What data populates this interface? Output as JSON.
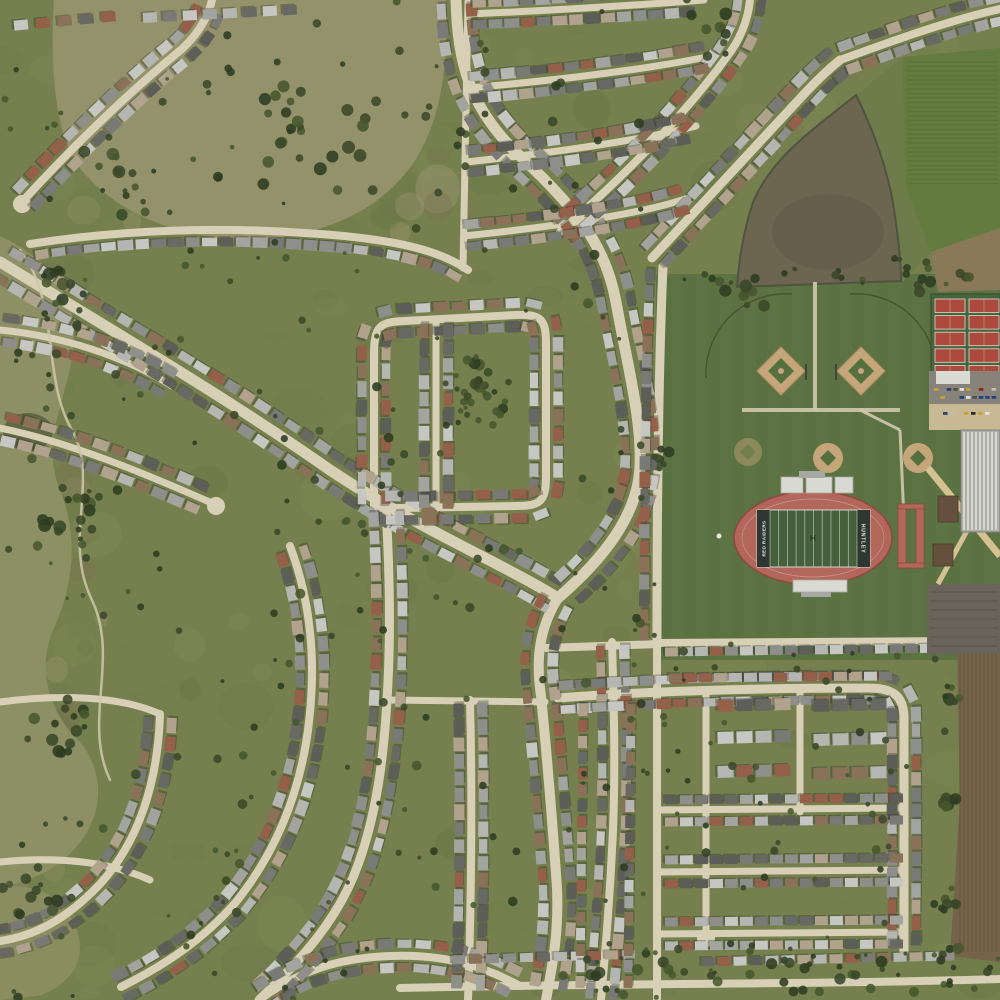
{
  "meta": {
    "description": "Aerial satellite view of a suburban subdivision with curving streets, a pond, farmland, and a high-school sports complex",
    "stadium_home_text": "RED RAIDERS",
    "stadium_away_text": "HUNTLEY",
    "midfield_mark": "H"
  },
  "palette": {
    "base": "#75804e",
    "road": "#d7d0b6",
    "trail": "#cfc9ac",
    "dirtRoad": "#cfc6a5",
    "shadow": "#23281b",
    "houses": [
      "#b5b5b1",
      "#a3a39f",
      "#8e8e8a",
      "#797975",
      "#696964",
      "#b0a28c",
      "#8a7258",
      "#95604a",
      "#c6c6c2",
      "#5e5e59"
    ],
    "trees": [
      "#3a4829",
      "#2e3c21",
      "#47562e"
    ],
    "scrub": "#93926a",
    "corridor": "#8d9064",
    "scrubB": "#8a8d60",
    "pond": "#6c6550",
    "pondDeep": "#615a46",
    "pondEdge": "#4e5440",
    "wetland": "#59603f",
    "farmGreen": "#647b3f",
    "farmStripe": "#597036",
    "grassStrip": "#6e7b4a",
    "farmBrownNE": "#8a7957",
    "farmBrownE": "#75644a",
    "farmStriate": "#5c4e38",
    "sports": "#5e7343",
    "sportsStripe": "#53673a",
    "track": "#b3675b",
    "trackEdge": "#8c4a40",
    "field": "#45603a",
    "endzone": "#2f3733",
    "lineWhite": "#dfe3da",
    "bleacher": "#d9d9d3",
    "bleacherDark": "#a8a8a2",
    "infield": "#c5a67b",
    "infieldEdge": "#ac8f63",
    "infieldGreen": "#55703e",
    "fenceDark": "#3f4c2c",
    "tennisRed": "#ac4a3e",
    "tennisGreen": "#47663f",
    "courtLine": "#ddd8cd",
    "lot": "#87837a",
    "lotDark": "#69655b",
    "lotLine": "#59554b",
    "canopy": "#dbdbd6",
    "drive": "#c8b995",
    "plaza": "#d4c191",
    "school": "#aeaea9",
    "schoolStripe": "#d7d7d2",
    "brown": "#65503e",
    "cars": [
      "#e0e0db",
      "#2b2b2b",
      "#93241e",
      "#24407e",
      "#bdbdb8",
      "#50504b",
      "#c7a23a"
    ],
    "mottle": [
      "#6d7a4a",
      "#83905a",
      "#5f6c40"
    ],
    "scrubMottle": [
      "#7b7052",
      "#9a9570",
      "#6e7a4e"
    ]
  },
  "scene": {
    "seed": 42,
    "mottle": [
      {
        "x": 0,
        "y": 0,
        "w": 1000,
        "h": 1000,
        "n": 160,
        "colors": "mottle",
        "rMin": 8,
        "rMax": 30,
        "opMin": 0.1,
        "opMax": 0.25
      },
      {
        "x": 60,
        "y": 0,
        "w": 380,
        "h": 235,
        "n": 50,
        "colors": "scrubMottle",
        "rMin": 6,
        "rMax": 26,
        "opMin": 0.25,
        "opMax": 0.5
      },
      {
        "x": 0,
        "y": 240,
        "w": 105,
        "h": 650,
        "n": 40,
        "colors": "scrubMottle",
        "rMin": 5,
        "rMax": 20,
        "opMin": 0.2,
        "opMax": 0.45
      }
    ],
    "regionsA": [
      {
        "type": "path",
        "name": "scrub-meadow-northwest",
        "d": "M54,0 L446,0 C448,62 442,112 420,152 C390,206 328,236 258,239 C178,242 108,210 74,160 C54,122 50,62 54,0 Z",
        "fill": "scrub"
      },
      {
        "type": "path",
        "name": "open-land-west-corridor",
        "d": "M0,236 C52,260 80,300 73,352 C66,402 40,440 60,490 C80,540 72,590 53,630 C37,668 48,710 78,740 C100,764 105,800 88,830 C70,862 40,880 0,887 Z",
        "fill": "corridor"
      },
      {
        "type": "path",
        "name": "scrub-southwest",
        "d": "M0,887 C40,881 72,902 79,938 C84,963 69,986 38,996 L0,1000 Z",
        "fill": "scrubB"
      },
      {
        "type": "rect",
        "name": "sports-complex-grounds",
        "x": 656,
        "y": 274,
        "w": 344,
        "h": 386,
        "fill": "sports"
      },
      {
        "type": "path",
        "name": "farm-field-northeast",
        "d": "M903,57 L1000,48 L1000,228 L931,252 L905,186 Z",
        "fill": "farmGreen"
      }
    ],
    "stripes1": [
      {
        "axis": "h",
        "x1": 907,
        "x2": 998,
        "y1": 62,
        "y2": 184,
        "step": 4.5,
        "stroke": "farmStripe",
        "w": 1.6,
        "op": 0.7
      },
      {
        "axis": "v",
        "x1": 666,
        "x2": 996,
        "y1": 276,
        "y2": 658,
        "step": 24,
        "stroke": "sportsStripe",
        "w": 11,
        "op": 0.16
      }
    ],
    "regionsB": [
      {
        "type": "path",
        "name": "grass-strip-pond-east",
        "d": "M856,95 L903,57 L905,186 L931,252 L903,282 Z",
        "fill": "grassStrip"
      },
      {
        "type": "path",
        "name": "farm-brown-northeast",
        "d": "M931,252 L1000,228 L1000,290 L938,292 Z",
        "fill": "farmBrownNE"
      },
      {
        "type": "path",
        "name": "plowed-field-east",
        "d": "M957,640 L1000,640 L1000,962 L950,956 L960,800 Z",
        "fill": "farmBrownE"
      },
      {
        "type": "path",
        "name": "retention-pond",
        "d": "M856,95 C867,117 885,158 893,203 C898,235 901,261 901,281 L737,287 C739,257 744,231 752,205 C770,158 814,129 856,95 Z",
        "fill": "pond",
        "stroke": "pondEdge",
        "sw": 2
      },
      {
        "type": "ellipse",
        "name": "pond-deep-water",
        "cx": 828,
        "cy": 232,
        "rx": 56,
        "ry": 38,
        "fill": "pondDeep",
        "op": 0.55
      },
      {
        "type": "ellipse",
        "name": "wetland-patch",
        "cx": 28,
        "cy": 432,
        "rx": 25,
        "ry": 19,
        "fill": "wetland",
        "op": 0.85
      }
    ],
    "stripes2": [
      {
        "axis": "v",
        "x1": 960,
        "x2": 998,
        "y1": 652,
        "y2": 952,
        "step": 4,
        "stroke": "farmStriate",
        "w": 1.4,
        "op": 0.45
      }
    ],
    "roads": [
      {
        "d": "M0,262 C120,335 230,400 330,470 C420,530 500,562 558,598",
        "w": 11,
        "hs": 18,
        "off": 15,
        "sides": [
          1,
          -1
        ]
      },
      {
        "d": "M456,0 C458,62 468,108 522,158 C576,208 606,246 616,302 C628,368 642,420 640,466 C638,516 602,560 558,598",
        "w": 11,
        "hs": 18,
        "off": 15,
        "sides": [
          1,
          -1
        ]
      },
      {
        "d": "M558,598 C538,630 536,662 541,696 C548,766 553,830 557,888 C559,936 552,966 546,1000",
        "w": 10,
        "hs": 18,
        "off": 14,
        "sides": [
          1,
          -1
        ]
      },
      {
        "d": "M663,266 C659,360 657,470 657,642",
        "w": 9,
        "hs": 17,
        "off": 13,
        "sides": [
          1
        ]
      },
      {
        "d": "M652,258 C700,206 756,146 806,92 C820,77 830,68 840,60",
        "w": 9,
        "hs": 17,
        "off": 13,
        "sides": [
          1,
          -1
        ]
      },
      {
        "d": "M840,60 C895,40 950,20 1000,9",
        "w": 8,
        "hs": 17,
        "off": 12,
        "sides": [
          1,
          -1
        ]
      },
      {
        "d": "M560,232 C622,178 682,118 726,58 C740,40 748,20 750,0",
        "w": 8,
        "hs": 17,
        "off": 12,
        "sides": [
          1,
          -1
        ]
      },
      {
        "d": "M22,202 C62,158 122,98 176,54 C196,38 208,18 212,0",
        "w": 8,
        "hs": 18,
        "off": 12,
        "sides": [
          1,
          -1
        ],
        "bulb": [
          [
            22,
            204
          ]
        ]
      },
      {
        "d": "M30,244 C120,230 220,226 320,234 C402,240 442,252 468,270",
        "w": 8,
        "hs": 17,
        "off": 12,
        "sides": [
          1
        ]
      },
      {
        "d": "M374,508 L374,354 C374,326 380,322 404,321 L516,315 C542,314 546,320 546,344 L546,476 C546,502 540,506 516,506 L404,508 Z",
        "w": 8,
        "hs": 18,
        "off": 12,
        "sides": [
          1,
          -1
        ]
      },
      {
        "d": "M436,321 L436,507",
        "w": 7,
        "hs": 17,
        "off": 12,
        "sides": [
          1,
          -1
        ]
      },
      {
        "d": "M470,14 C560,10 640,5 704,0",
        "w": 7,
        "hs": 16,
        "off": 11,
        "sides": [
          1,
          -1
        ]
      },
      {
        "d": "M468,88 C560,80 640,70 702,58",
        "w": 7,
        "hs": 16,
        "off": 11,
        "sides": [
          1,
          -1
        ]
      },
      {
        "d": "M466,162 C560,152 642,140 696,126",
        "w": 7,
        "hs": 16,
        "off": 11,
        "sides": [
          1,
          -1
        ]
      },
      {
        "d": "M464,236 C560,226 642,214 688,198",
        "w": 7,
        "hs": 16,
        "off": 11,
        "sides": [
          1,
          -1
        ]
      },
      {
        "d": "M468,2 L463,268",
        "w": 7
      },
      {
        "d": "M0,330 C62,336 124,356 172,386",
        "w": 7,
        "hs": 18,
        "off": 12,
        "sides": [
          1,
          -1
        ]
      },
      {
        "d": "M0,428 C70,442 146,474 214,504",
        "w": 7,
        "hs": 18,
        "off": 12,
        "sides": [
          1,
          -1
        ],
        "bulb": [
          [
            216,
            506
          ]
        ]
      },
      {
        "d": "M386,508 C389,560 391,620 388,682 C385,744 379,806 359,862 C339,920 299,962 259,1000",
        "w": 9,
        "hs": 18,
        "off": 13,
        "sides": [
          1,
          -1
        ]
      },
      {
        "d": "M290,546 C311,602 316,662 309,722 C301,792 276,852 236,902 C201,942 161,967 121,987",
        "w": 8,
        "hs": 18,
        "off": 12,
        "sides": [
          1,
          -1
        ]
      },
      {
        "d": "M160,714 C158,780 140,840 100,884 C66,920 34,936 0,941",
        "w": 8,
        "hs": 18,
        "off": 12,
        "sides": [
          1,
          -1
        ]
      },
      {
        "d": "M0,702 C60,694 120,696 160,714",
        "w": 7
      },
      {
        "d": "M0,862 C60,856 110,862 150,880",
        "w": 7
      },
      {
        "d": "M259,1000 C300,970 340,958 390,956 C440,954 480,964 520,986",
        "w": 8,
        "hs": 18,
        "off": 12,
        "sides": [
          1,
          -1
        ]
      },
      {
        "d": "M470,700 C472,780 472,880 468,1000",
        "w": 8,
        "hs": 17,
        "off": 12,
        "sides": [
          1,
          -1
        ]
      },
      {
        "d": "M388,700 L545,702",
        "w": 7
      },
      {
        "d": "M612,642 C614,710 616,780 612,850 C609,910 605,955 601,1000",
        "w": 8,
        "hs": 17,
        "off": 12,
        "sides": [
          1,
          -1
        ]
      },
      {
        "d": "M546,648 L658,644",
        "w": 8
      },
      {
        "d": "M558,698 C650,691 760,688 868,688 C896,688 903,698 904,716 L904,952",
        "w": 9,
        "hs": 16,
        "off": 12,
        "sides": [
          1,
          -1
        ]
      },
      {
        "d": "M657,643 L957,641",
        "w": 8
      },
      {
        "d": "M657,645 L657,1000",
        "w": 8
      },
      {
        "d": "M706,690 L706,936",
        "w": 7,
        "bulb": [
          [
            706,
            938
          ]
        ]
      },
      {
        "d": "M800,690 L800,812",
        "w": 7
      },
      {
        "d": "M658,810 L902,808",
        "w": 7
      },
      {
        "d": "M658,872 L902,870",
        "w": 7
      },
      {
        "d": "M658,934 L902,932",
        "w": 7
      },
      {
        "d": "M400,988 C600,983 800,985 1000,979",
        "w": 8
      }
    ],
    "trails": [
      {
        "d": "M20,250 C60,300 42,380 72,430 C100,480 62,540 92,600 C120,660 82,720 110,780",
        "w": 2.5,
        "stroke": "trail"
      }
    ],
    "houseRows": [
      [
        10,
        26,
        118,
        16,
        22,
        14,
        10
      ],
      [
        140,
        18,
        308,
        9,
        20,
        14,
        10
      ],
      [
        664,
        652,
        952,
        648,
        15,
        13,
        9
      ],
      [
        668,
        678,
        894,
        676,
        15,
        13,
        9
      ],
      [
        716,
        706,
        792,
        704,
        19,
        16,
        12
      ],
      [
        716,
        738,
        792,
        736,
        19,
        16,
        12
      ],
      [
        716,
        772,
        792,
        770,
        19,
        16,
        12
      ],
      [
        812,
        706,
        892,
        704,
        19,
        16,
        12
      ],
      [
        812,
        740,
        892,
        738,
        19,
        16,
        12
      ],
      [
        812,
        774,
        892,
        772,
        19,
        16,
        12
      ],
      [
        664,
        800,
        898,
        798,
        15,
        13,
        9
      ],
      [
        664,
        822,
        898,
        820,
        15,
        13,
        9
      ],
      [
        664,
        860,
        898,
        858,
        15,
        13,
        9
      ],
      [
        664,
        884,
        898,
        882,
        15,
        13,
        9
      ],
      [
        664,
        922,
        898,
        920,
        15,
        13,
        9
      ],
      [
        664,
        946,
        898,
        944,
        15,
        13,
        9
      ],
      [
        450,
        960,
        640,
        954,
        17,
        13,
        9
      ],
      [
        700,
        962,
        950,
        956,
        16,
        13,
        9
      ],
      [
        583,
        702,
        580,
        986,
        16,
        12,
        9
      ],
      [
        631,
        702,
        628,
        986,
        16,
        12,
        9
      ]
    ],
    "treeClusters": [
      {
        "x": 480,
        "y": 398,
        "r": 42,
        "n": 30
      },
      {
        "x": 300,
        "y": 120,
        "r": 80,
        "n": 26
      },
      {
        "x": 120,
        "y": 180,
        "r": 50,
        "n": 14
      },
      {
        "x": 55,
        "y": 300,
        "r": 40,
        "n": 16
      },
      {
        "x": 60,
        "y": 520,
        "r": 45,
        "n": 16
      },
      {
        "x": 70,
        "y": 720,
        "r": 45,
        "n": 16
      },
      {
        "x": 40,
        "y": 900,
        "r": 45,
        "n": 14
      },
      {
        "x": 905,
        "y": 270,
        "r": 28,
        "n": 8
      },
      {
        "x": 745,
        "y": 295,
        "r": 30,
        "n": 8
      },
      {
        "x": 700,
        "y": 30,
        "r": 40,
        "n": 10
      },
      {
        "x": 660,
        "y": 460,
        "r": 16,
        "n": 8
      },
      {
        "x": 952,
        "y": 700,
        "r": 18,
        "n": 8
      },
      {
        "x": 950,
        "y": 800,
        "r": 16,
        "n": 8
      },
      {
        "x": 948,
        "y": 900,
        "r": 16,
        "n": 8
      }
    ],
    "treeScatter": [
      {
        "x": 0,
        "y": 0,
        "w": 660,
        "h": 1000,
        "n": 240,
        "rmax": 5
      },
      {
        "x": 660,
        "y": 640,
        "w": 290,
        "h": 330,
        "n": 55,
        "rmax": 4.5
      },
      {
        "x": 560,
        "y": 948,
        "w": 440,
        "h": 50,
        "n": 60,
        "rmax": 6
      },
      {
        "x": 660,
        "y": 268,
        "w": 320,
        "h": 16,
        "n": 20,
        "rmax": 5
      }
    ],
    "baseball": {
      "big": [
        {
          "cx": 781,
          "cy": 371,
          "fence": "M706,378 A80,80 0 0 1 792,294"
        },
        {
          "cx": 861,
          "cy": 371,
          "fence": "M936,378 A80,80 0 0 0 850,294"
        }
      ],
      "r": 24,
      "inner": 13,
      "backstops": [
        [
          806,
          364,
          806,
          380
        ],
        [
          836,
          364,
          836,
          380
        ]
      ],
      "small": [
        {
          "cx": 828,
          "cy": 458,
          "r": 15,
          "op": 1
        },
        {
          "cx": 918,
          "cy": 458,
          "r": 15,
          "op": 1
        },
        {
          "cx": 748,
          "cy": 452,
          "r": 14,
          "op": 0.45
        }
      ]
    },
    "walkways": [
      {
        "d": "M815,282 L815,410",
        "w": 4
      },
      {
        "d": "M742,410 L900,410",
        "w": 4
      },
      {
        "d": "M860,410 L900,430",
        "w": 3
      },
      {
        "d": "M900,430 L904,520",
        "w": 3
      }
    ],
    "stadium": {
      "cx": 813,
      "cy": 538,
      "rx": 79,
      "ry": 47,
      "fx": 757,
      "fy": 510,
      "fw": 113,
      "fh": 57,
      "ez": 13,
      "bleachersN": [
        [
          781,
          477,
          22,
          16
        ],
        [
          806,
          477,
          26,
          16
        ],
        [
          835,
          477,
          18,
          16
        ]
      ],
      "pressBox": [
        799,
        471,
        26,
        7
      ],
      "bleachersS": [
        [
          793,
          580,
          54,
          12
        ]
      ],
      "south2": [
        801,
        592,
        30,
        5
      ],
      "runway": {
        "xs": [
          898,
          916
        ],
        "y": 504,
        "w": 8,
        "h": 64,
        "bar": 26
      },
      "flag": [
        719,
        536
      ]
    },
    "tennis": {
      "x": 931,
      "y": 294,
      "w": 69,
      "h": 86,
      "rows": 5,
      "cols": 2,
      "cw": 30,
      "ch": 13.5,
      "gx": 34,
      "gy": 16.6,
      "ox": 4,
      "oy": 5
    },
    "campus": {
      "lots": [
        {
          "x": 929,
          "y": 371,
          "w": 71,
          "h": 33,
          "fill": "lot"
        },
        {
          "x": 929,
          "y": 404,
          "w": 71,
          "h": 26,
          "fill": "drive"
        },
        {
          "x": 927,
          "y": 584,
          "w": 73,
          "h": 70,
          "fill": "lotDark"
        }
      ],
      "canopy": [
        936,
        371,
        34,
        13
      ],
      "school": {
        "x": 961,
        "y": 430,
        "w": 39,
        "h": 102
      },
      "brownBldgs": [
        [
          938,
          496,
          20,
          26
        ],
        [
          933,
          544,
          20,
          22
        ]
      ],
      "plazaPaths": [
        {
          "d": "M928,468 L1000,556",
          "w": 7
        },
        {
          "d": "M1000,470 L938,584",
          "w": 5
        }
      ],
      "lotLines": {
        "x1": 930,
        "x2": 998,
        "y1": 592,
        "y2": 648,
        "step": 9
      },
      "carRows": [
        {
          "x": 934,
          "y": 388,
          "n": 10,
          "dx": 6.4
        },
        {
          "x": 934,
          "y": 396,
          "n": 10,
          "dx": 6.4
        },
        {
          "x": 936,
          "y": 412,
          "n": 8,
          "dx": 7
        }
      ]
    }
  }
}
